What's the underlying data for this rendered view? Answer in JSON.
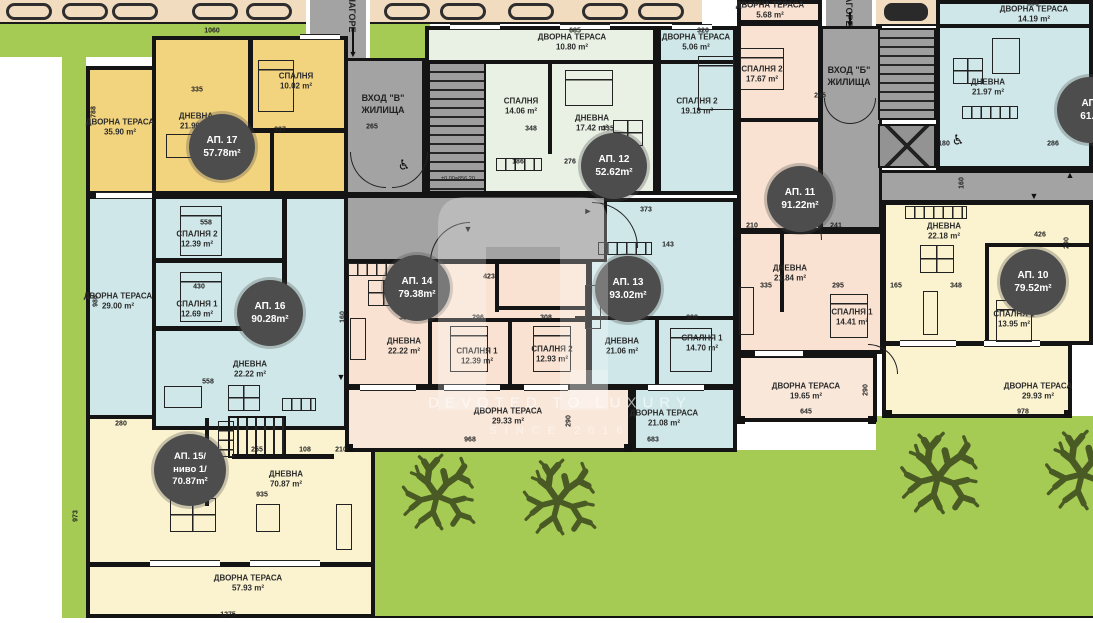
{
  "plan": {
    "watermark_line1": "DEVOTED TO LUXURY",
    "watermark_line2": "SINCE 2016",
    "walkway_label": "НАГОРЕ",
    "elevation_marker": "±0.00=856.20"
  },
  "entrances": {
    "v": {
      "line1": "ВХОД \"В\"",
      "line2": "ЖИЛИЩА"
    },
    "b": {
      "line1": "ВХОД \"Б\"",
      "line2": "ЖИЛИЩА"
    }
  },
  "badges": {
    "ap17": {
      "name": "АП. 17",
      "area": "57.78m²"
    },
    "ap12": {
      "name": "АП. 12",
      "area": "52.62m²"
    },
    "ap11": {
      "name": "АП. 11",
      "area": "91.22m²"
    },
    "ap14": {
      "name": "АП. 14",
      "area": "79.38m²"
    },
    "ap13": {
      "name": "АП. 13",
      "area": "93.02m²"
    },
    "ap16": {
      "name": "АП. 16",
      "area": "90.28m²"
    },
    "ap10": {
      "name": "АП. 10",
      "area": "79.52m²"
    },
    "ap15": {
      "name": "АП. 15/",
      "level": "ниво 1/",
      "area": "70.87m²"
    },
    "ap9": {
      "name": "АП.",
      "area": "61.3"
    }
  },
  "rooms": [
    {
      "name": "ДВОРНА ТЕРАСА",
      "area": "35.90 m²"
    },
    {
      "name": "ДНЕВНА",
      "area": "21.96 m²"
    },
    {
      "name": "СПАЛНЯ",
      "area": "10.02 m²"
    },
    {
      "name": "ДВОРНА ТЕРАСА",
      "area": "10.80 m²"
    },
    {
      "name": "СПАЛНЯ",
      "area": "14.06 m²"
    },
    {
      "name": "ДНЕВНА",
      "area": "17.42 m²"
    },
    {
      "name": "ДВОРНА ТЕРАСА",
      "area": "5.06 m²"
    },
    {
      "name": "СПАЛНЯ 2",
      "area": "19.18 m²"
    },
    {
      "name": "ДВОРНА ТЕРАСА",
      "area": "5.68 m²"
    },
    {
      "name": "СПАЛНЯ 2",
      "area": "17.67 m²"
    },
    {
      "name": "ДВОРНА ТЕРАСА",
      "area": "14.19 m²"
    },
    {
      "name": "ДНЕВНА",
      "area": "21.97 m²"
    },
    {
      "name": "СПАЛНЯ 2",
      "area": "12.39 m²"
    },
    {
      "name": "СПАЛНЯ 1",
      "area": "12.69 m²"
    },
    {
      "name": "ДВОРНА ТЕРАСА",
      "area": "29.00 m²"
    },
    {
      "name": "ДНЕВНА",
      "area": "22.22 m²"
    },
    {
      "name": "ДНЕВНА",
      "area": "22.22 m²"
    },
    {
      "name": "СПАЛНЯ 1",
      "area": "12.39 m²"
    },
    {
      "name": "СПАЛНЯ 2",
      "area": "12.93 m²"
    },
    {
      "name": "ДНЕВНА",
      "area": "21.06 m²"
    },
    {
      "name": "СПАЛНЯ 1",
      "area": "14.70 m²"
    },
    {
      "name": "ДНЕВНА",
      "area": "21.84 m²"
    },
    {
      "name": "СПАЛНЯ 1",
      "area": "14.41 m²"
    },
    {
      "name": "ДВОРНА ТЕРАСА",
      "area": "19.65 m²"
    },
    {
      "name": "ДНЕВНА",
      "area": "22.18 m²"
    },
    {
      "name": "СПАЛНЯ 1",
      "area": "13.95 m²"
    },
    {
      "name": "ДВОРНА ТЕРАСА",
      "area": "29.93 m²"
    },
    {
      "name": "ДВОРНА ТЕРАСА",
      "area": "29.33 m²"
    },
    {
      "name": "ДВОРНА ТЕРАСА",
      "area": "21.08 m²"
    },
    {
      "name": "ДНЕВНА",
      "area": "70.87 m²"
    },
    {
      "name": "ДВОРНА ТЕРАСА",
      "area": "57.93 m²"
    }
  ],
  "dims": [
    "1060",
    "788",
    "265",
    "685",
    "320",
    "865",
    "295",
    "335",
    "337",
    "348",
    "335",
    "186",
    "276",
    "373",
    "143",
    "160",
    "335",
    "296",
    "308",
    "423",
    "335",
    "308",
    "335",
    "295",
    "165",
    "348",
    "426",
    "290",
    "968",
    "683",
    "290",
    "645",
    "290",
    "978",
    "935",
    "255",
    "108",
    "210",
    "280",
    "973",
    "1275",
    "558",
    "430",
    "558",
    "980",
    "180",
    "286",
    "241",
    "210",
    "160"
  ],
  "colors": {
    "lawn": "#a5cb55",
    "tree": "#4a5a24",
    "corridor": "#a3a3a3",
    "wall": "#141414",
    "unit_gold": "#f2d37e",
    "unit_mint": "#e9f1e4",
    "unit_blue": "#cfe7e9",
    "unit_peach": "#f9e2d2",
    "unit_pale_yellow": "#fbf3cf",
    "badge": "#4d4d4d",
    "parking": "#f1dcc0"
  }
}
